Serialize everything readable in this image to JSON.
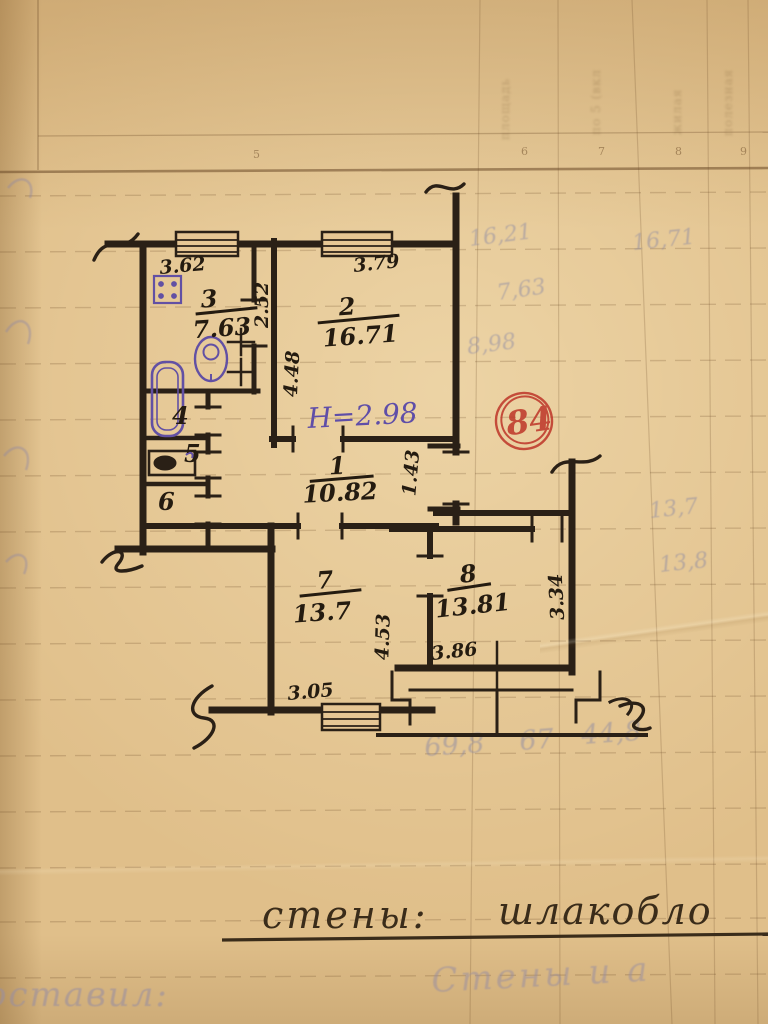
{
  "stamp": {
    "number": "84",
    "color": "#bf3a2c"
  },
  "height_note": {
    "text": "H=2.98",
    "color": "#5f4ea8"
  },
  "rooms": [
    {
      "number": "1",
      "area": "10.82"
    },
    {
      "number": "2",
      "area": "16.71"
    },
    {
      "number": "3",
      "area": "7.63"
    },
    {
      "number": "4",
      "area": ""
    },
    {
      "number": "5",
      "area": ""
    },
    {
      "number": "6",
      "area": ""
    },
    {
      "number": "7",
      "area": "13.7"
    },
    {
      "number": "8",
      "area": "13.81"
    }
  ],
  "dimensions": {
    "kitchen_top": "3.62",
    "room2_top": "3.79",
    "kitchen_right": "2.52",
    "room2_left": "4.48",
    "hall_entry": "1.43",
    "room7_right": "4.53",
    "room7_bottom": "3.05",
    "room8_window": "3.86",
    "room8_right": "3.34"
  },
  "table": {
    "column_numbers": [
      "5",
      "6",
      "7",
      "8",
      "9"
    ]
  },
  "bleed_through": {
    "right_numbers": [
      "16,21",
      "16,71",
      "7,63",
      "8,98",
      "13,7",
      "13,8"
    ],
    "bottom_numbers": [
      "69,8",
      "67",
      "44,8"
    ],
    "header_words": [
      "площадь",
      "по 5 (вкл",
      "жилая",
      "полезная"
    ]
  },
  "captions": {
    "walls_label": "стены:",
    "walls_value": "шлакобло",
    "pencil_left": "оставил:",
    "pencil_right": "Стены и а"
  }
}
